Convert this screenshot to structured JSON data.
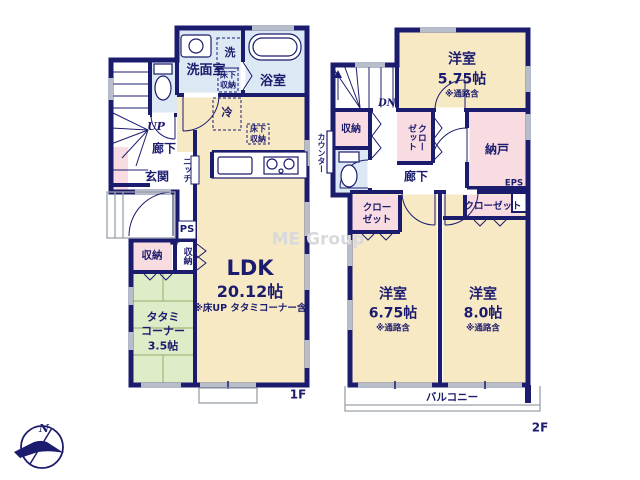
{
  "watermark": "ME Group",
  "compass": {
    "north": "N"
  },
  "floor1": {
    "floor_label": "1F",
    "washroom": "洗面室",
    "washer": "洗",
    "bathroom": "浴室",
    "underfloor_storage_1": {
      "line1": "床下",
      "line2": "収納"
    },
    "underfloor_storage_2": {
      "line1": "床下",
      "line2": "収納"
    },
    "fridge": "冷",
    "stairs_up": "UP",
    "hallway": "廊下",
    "entrance": "玄関",
    "niche": "ニッチ",
    "pipe_space": "PS",
    "storage_a": "収納",
    "storage_b": "収納",
    "ldk": {
      "name": "LDK",
      "size": "20.12帖",
      "note": "※床UP タタミコーナー含"
    },
    "tatami": {
      "line1": "タタミ",
      "line2": "コーナー",
      "size": "3.5帖"
    }
  },
  "floor2": {
    "floor_label": "2F",
    "bedroom_1": {
      "name": "洋室",
      "size": "5.75帖",
      "note": "※通路含"
    },
    "bedroom_2": {
      "name": "洋室",
      "size": "6.75帖",
      "note": "※通路含"
    },
    "bedroom_3": {
      "name": "洋室",
      "size": "8.0帖",
      "note": "※通路含"
    },
    "stairs_down": "DN",
    "storage": "収納",
    "counter": "カウンター",
    "closet_1": "クローゼット",
    "storage_room": "納戸",
    "eps": "EPS",
    "hallway": "廊下",
    "closet_2": {
      "line1": "クロー",
      "line2": "ゼット"
    },
    "closet_3": "クローゼット",
    "balcony": "バルコニー"
  },
  "colors": {
    "wall": "#1c1c6e",
    "room_beige": "#f8e9c5",
    "wet_blue": "#dce8f4",
    "pink": "#f8dce1",
    "tatami_green": "#dfecc8",
    "window_gray": "#b7bdc9",
    "watermark_gray": "#d9d9dc"
  }
}
